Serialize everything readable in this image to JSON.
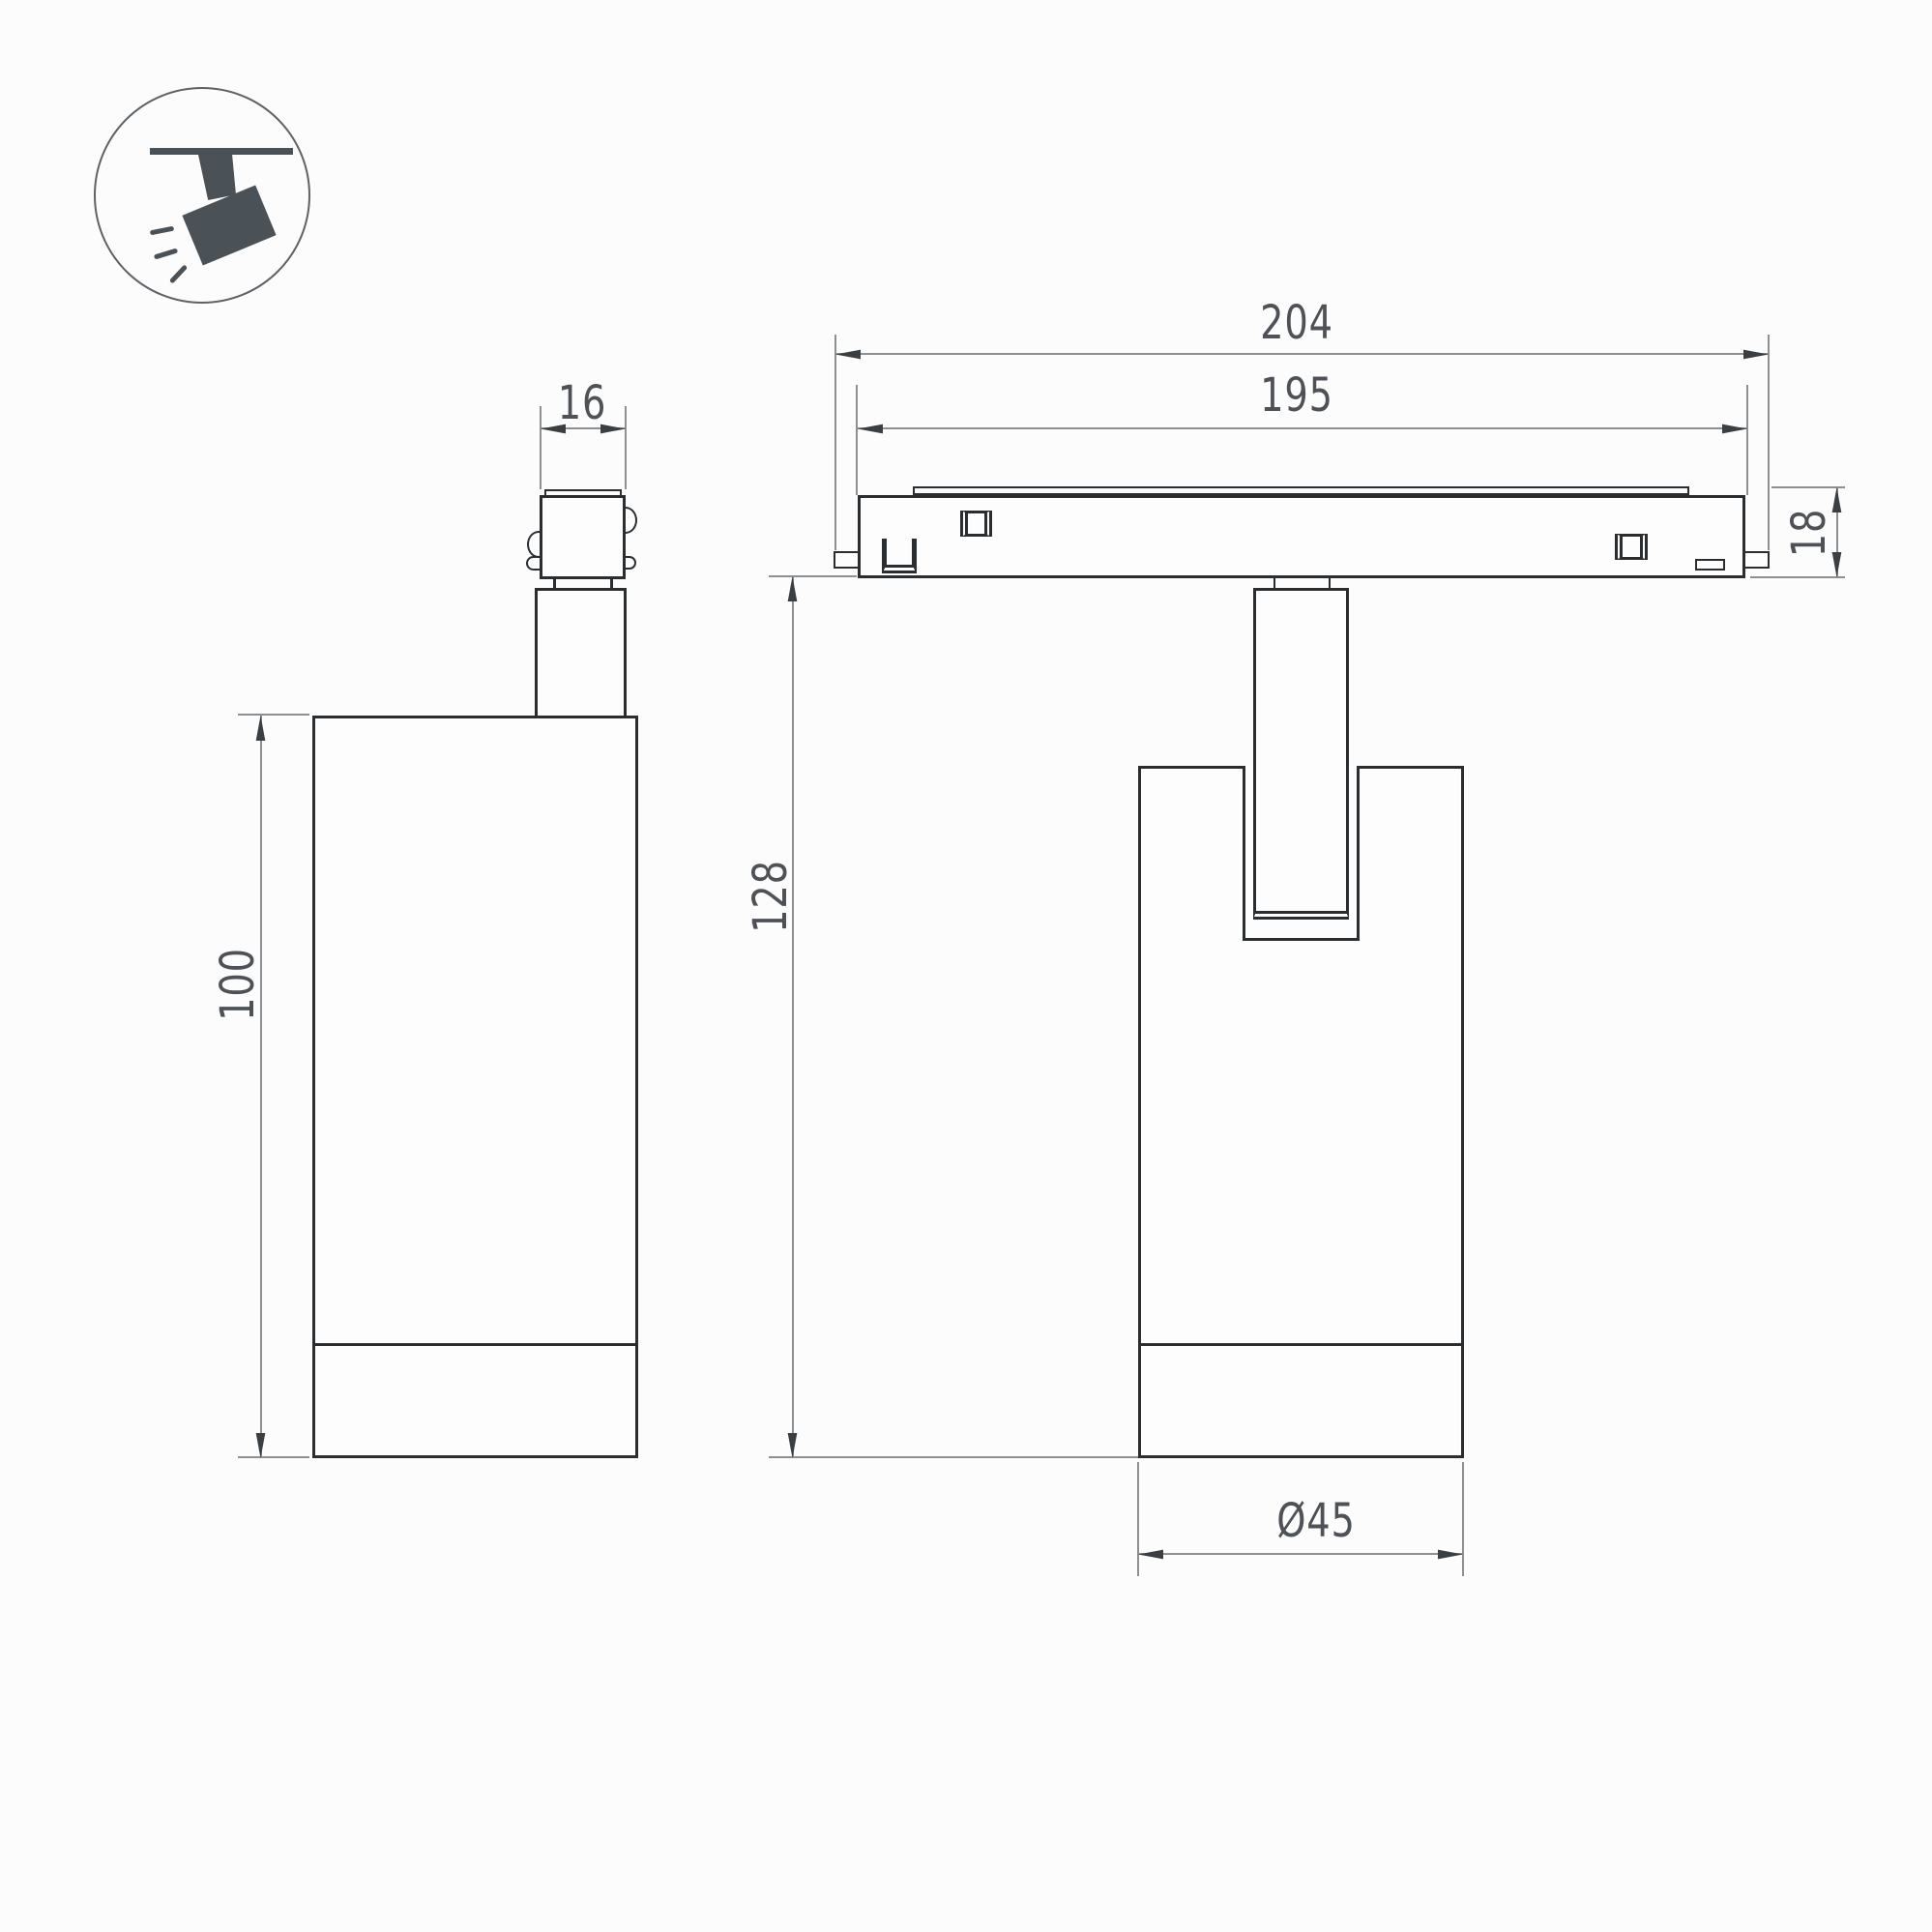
{
  "icon": {
    "name": "track-spotlight-icon"
  },
  "views": {
    "side": {
      "dimensions": {
        "connector_width": "16",
        "body_height": "100"
      }
    },
    "front": {
      "dimensions": {
        "overall_length": "204",
        "track_length": "195",
        "track_height": "18",
        "suspension_height": "128",
        "body_diameter": "Ø45"
      }
    }
  },
  "colors": {
    "line": "#2b2e31",
    "bg": "#fcfcfd",
    "fill": "#fdfdfe",
    "dim": "#8d9093",
    "arrow": "#3b3f42",
    "text": "#4e5256",
    "icon": "#4a5257",
    "circle": "#5d6266"
  }
}
